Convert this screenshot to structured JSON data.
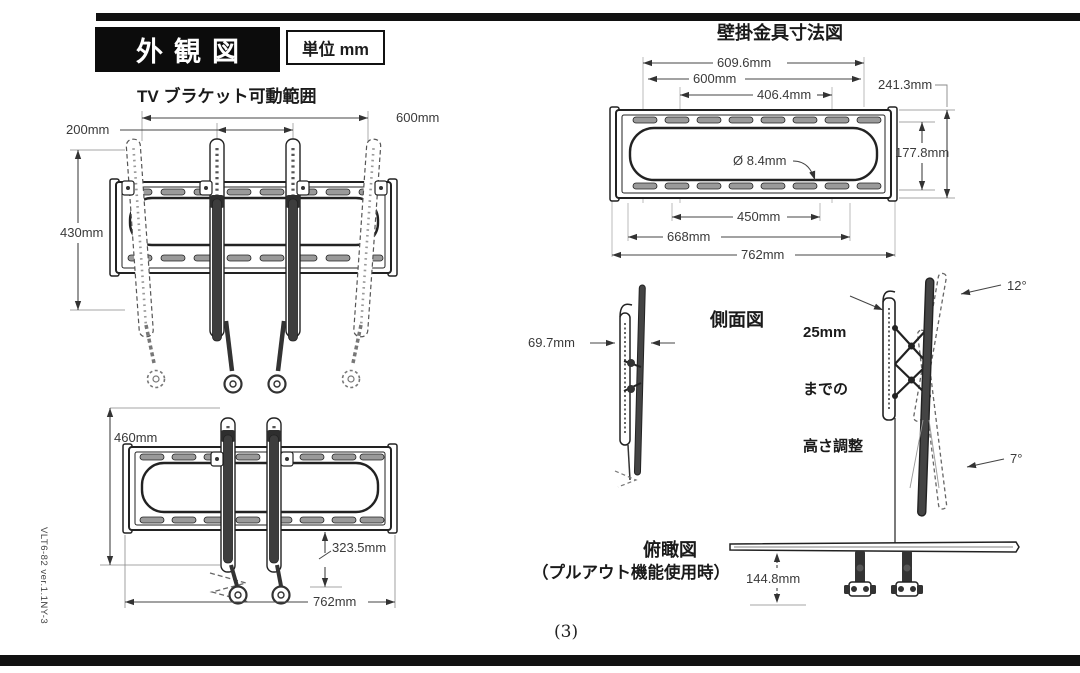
{
  "header": {
    "title": "外観図",
    "unit": "単位 mm"
  },
  "front_view": {
    "title": "TV ブラケット可動範囲",
    "dim_rail_span": "600mm",
    "dim_rail_gap": "200mm",
    "dim_height": "430mm"
  },
  "extended_view": {
    "dim_height": "460mm",
    "dim_drop": "323.5mm",
    "dim_width": "762mm"
  },
  "wall_plate": {
    "title": "壁掛金具寸法図",
    "dim_hole_span": "609.6mm",
    "dim_600": "600mm",
    "dim_406": "406.4mm",
    "dim_outer_height": "241.3mm",
    "dim_hole": "Ø 8.4mm",
    "dim_inner_height": "177.8mm",
    "dim_450": "450mm",
    "dim_668": "668mm",
    "dim_762": "762mm"
  },
  "side_view": {
    "title": "側面図",
    "dim_depth": "69.7mm",
    "height_adj_line1": "25mm",
    "height_adj_line2": "までの",
    "height_adj_line3": "高さ調整",
    "tilt_up": "12°",
    "tilt_down": "7°"
  },
  "top_view": {
    "title": "俯瞰図",
    "subtitle": "（プルアウト機能使用時）",
    "dim_pullout": "144.8mm"
  },
  "footer": {
    "page_number": "(3)",
    "product_code": "VLT6-82 ver.1.1NY-3"
  }
}
